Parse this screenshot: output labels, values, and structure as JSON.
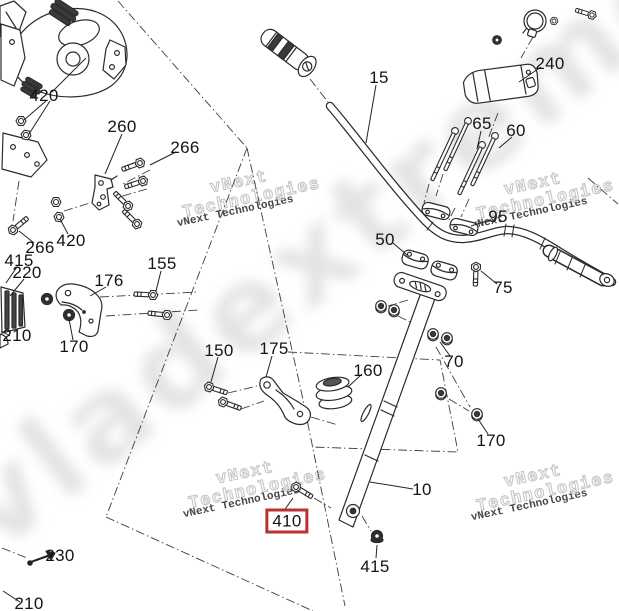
{
  "diagram": {
    "type": "exploded-parts-diagram",
    "background": "#ffffff",
    "line_color": "#2b2b2b",
    "highlight_color": "#b83230",
    "highlighted_callout": "410",
    "callouts": [
      {
        "label": "420",
        "x": 44,
        "y": 96
      },
      {
        "label": "260",
        "x": 122,
        "y": 127
      },
      {
        "label": "266",
        "x": 185,
        "y": 148
      },
      {
        "label": "266",
        "x": 40,
        "y": 248
      },
      {
        "label": "420",
        "x": 71,
        "y": 241
      },
      {
        "label": "415",
        "x": 19,
        "y": 261
      },
      {
        "label": "220",
        "x": 27,
        "y": 273
      },
      {
        "label": "210",
        "x": 17,
        "y": 336
      },
      {
        "label": "176",
        "x": 109,
        "y": 281
      },
      {
        "label": "155",
        "x": 162,
        "y": 264
      },
      {
        "label": "170",
        "x": 74,
        "y": 347
      },
      {
        "label": "150",
        "x": 219,
        "y": 351
      },
      {
        "label": "175",
        "x": 274,
        "y": 349
      },
      {
        "label": "160",
        "x": 368,
        "y": 371
      },
      {
        "label": "15",
        "x": 379,
        "y": 78
      },
      {
        "label": "240",
        "x": 550,
        "y": 64
      },
      {
        "label": "65",
        "x": 482,
        "y": 124
      },
      {
        "label": "60",
        "x": 516,
        "y": 131
      },
      {
        "label": "95",
        "x": 498,
        "y": 217
      },
      {
        "label": "50",
        "x": 385,
        "y": 240
      },
      {
        "label": "75",
        "x": 503,
        "y": 288
      },
      {
        "label": "70",
        "x": 454,
        "y": 362
      },
      {
        "label": "170",
        "x": 491,
        "y": 441
      },
      {
        "label": "10",
        "x": 422,
        "y": 490
      },
      {
        "label": "410",
        "x": 287,
        "y": 521,
        "boxed": true
      },
      {
        "label": "415",
        "x": 375,
        "y": 567
      },
      {
        "label": "230",
        "x": 60,
        "y": 556
      },
      {
        "label": "210",
        "x": 29,
        "y": 604
      }
    ]
  },
  "watermarks": {
    "small_text": "vNext Technologies",
    "outline_line1": "vNext",
    "outline_line2": "Technologies",
    "big_text": "vladextreme.ru",
    "pairs": [
      {
        "x": 176,
        "y": 206
      },
      {
        "x": 470,
        "y": 208
      },
      {
        "x": 182,
        "y": 497
      },
      {
        "x": 470,
        "y": 500
      }
    ]
  }
}
